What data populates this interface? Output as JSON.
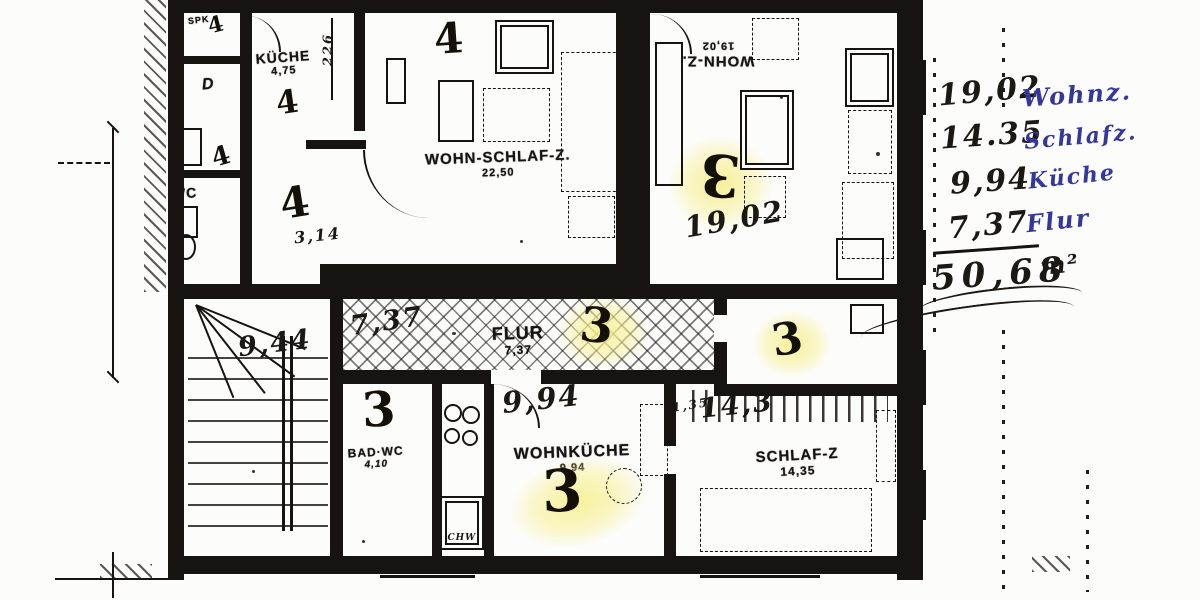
{
  "colors": {
    "ink": "#171310",
    "paper": "#fcfcfa",
    "highlight": "#f7f094",
    "blue_ink": "#34379b"
  },
  "apartments": {
    "three": "3",
    "four": "4"
  },
  "rooms": {
    "spk": {
      "label": "SPK"
    },
    "dusche": {
      "label": "D"
    },
    "wc": {
      "label": "WC"
    },
    "kueche": {
      "label": "KÜCHE",
      "area": "4,75"
    },
    "hall": {
      "note": "3,14"
    },
    "wohnschlafz": {
      "label": "WOHN-SCHLAF-Z.",
      "area": "22,50"
    },
    "wohnz": {
      "label": "WOHN-Z.",
      "area": "19,02",
      "note": "19,02"
    },
    "flur": {
      "label": "FLUR",
      "area": "7,37",
      "note": "7,37"
    },
    "treppe": {
      "note": "9,44"
    },
    "badwc": {
      "label": "BAD·WC",
      "area": "4,10"
    },
    "wohnkueche": {
      "label": "WOHNKÜCHE",
      "area": "9,94",
      "note": "9,94",
      "fixture": "SCHW"
    },
    "schlafz": {
      "label": "SCHLAF-Z",
      "area": "14,35",
      "note": "14,3",
      "note_small": "1,35"
    }
  },
  "dims": {
    "kueche_depth": "226"
  },
  "notes": {
    "items": [
      {
        "value": "19,02",
        "label": "Wohnz."
      },
      {
        "value": "14.35",
        "label": "Schlafz."
      },
      {
        "value": "9,94",
        "label": "Küche"
      },
      {
        "value": "7,37",
        "label": "Flur"
      }
    ],
    "total": "50,68",
    "unit": "m²"
  }
}
